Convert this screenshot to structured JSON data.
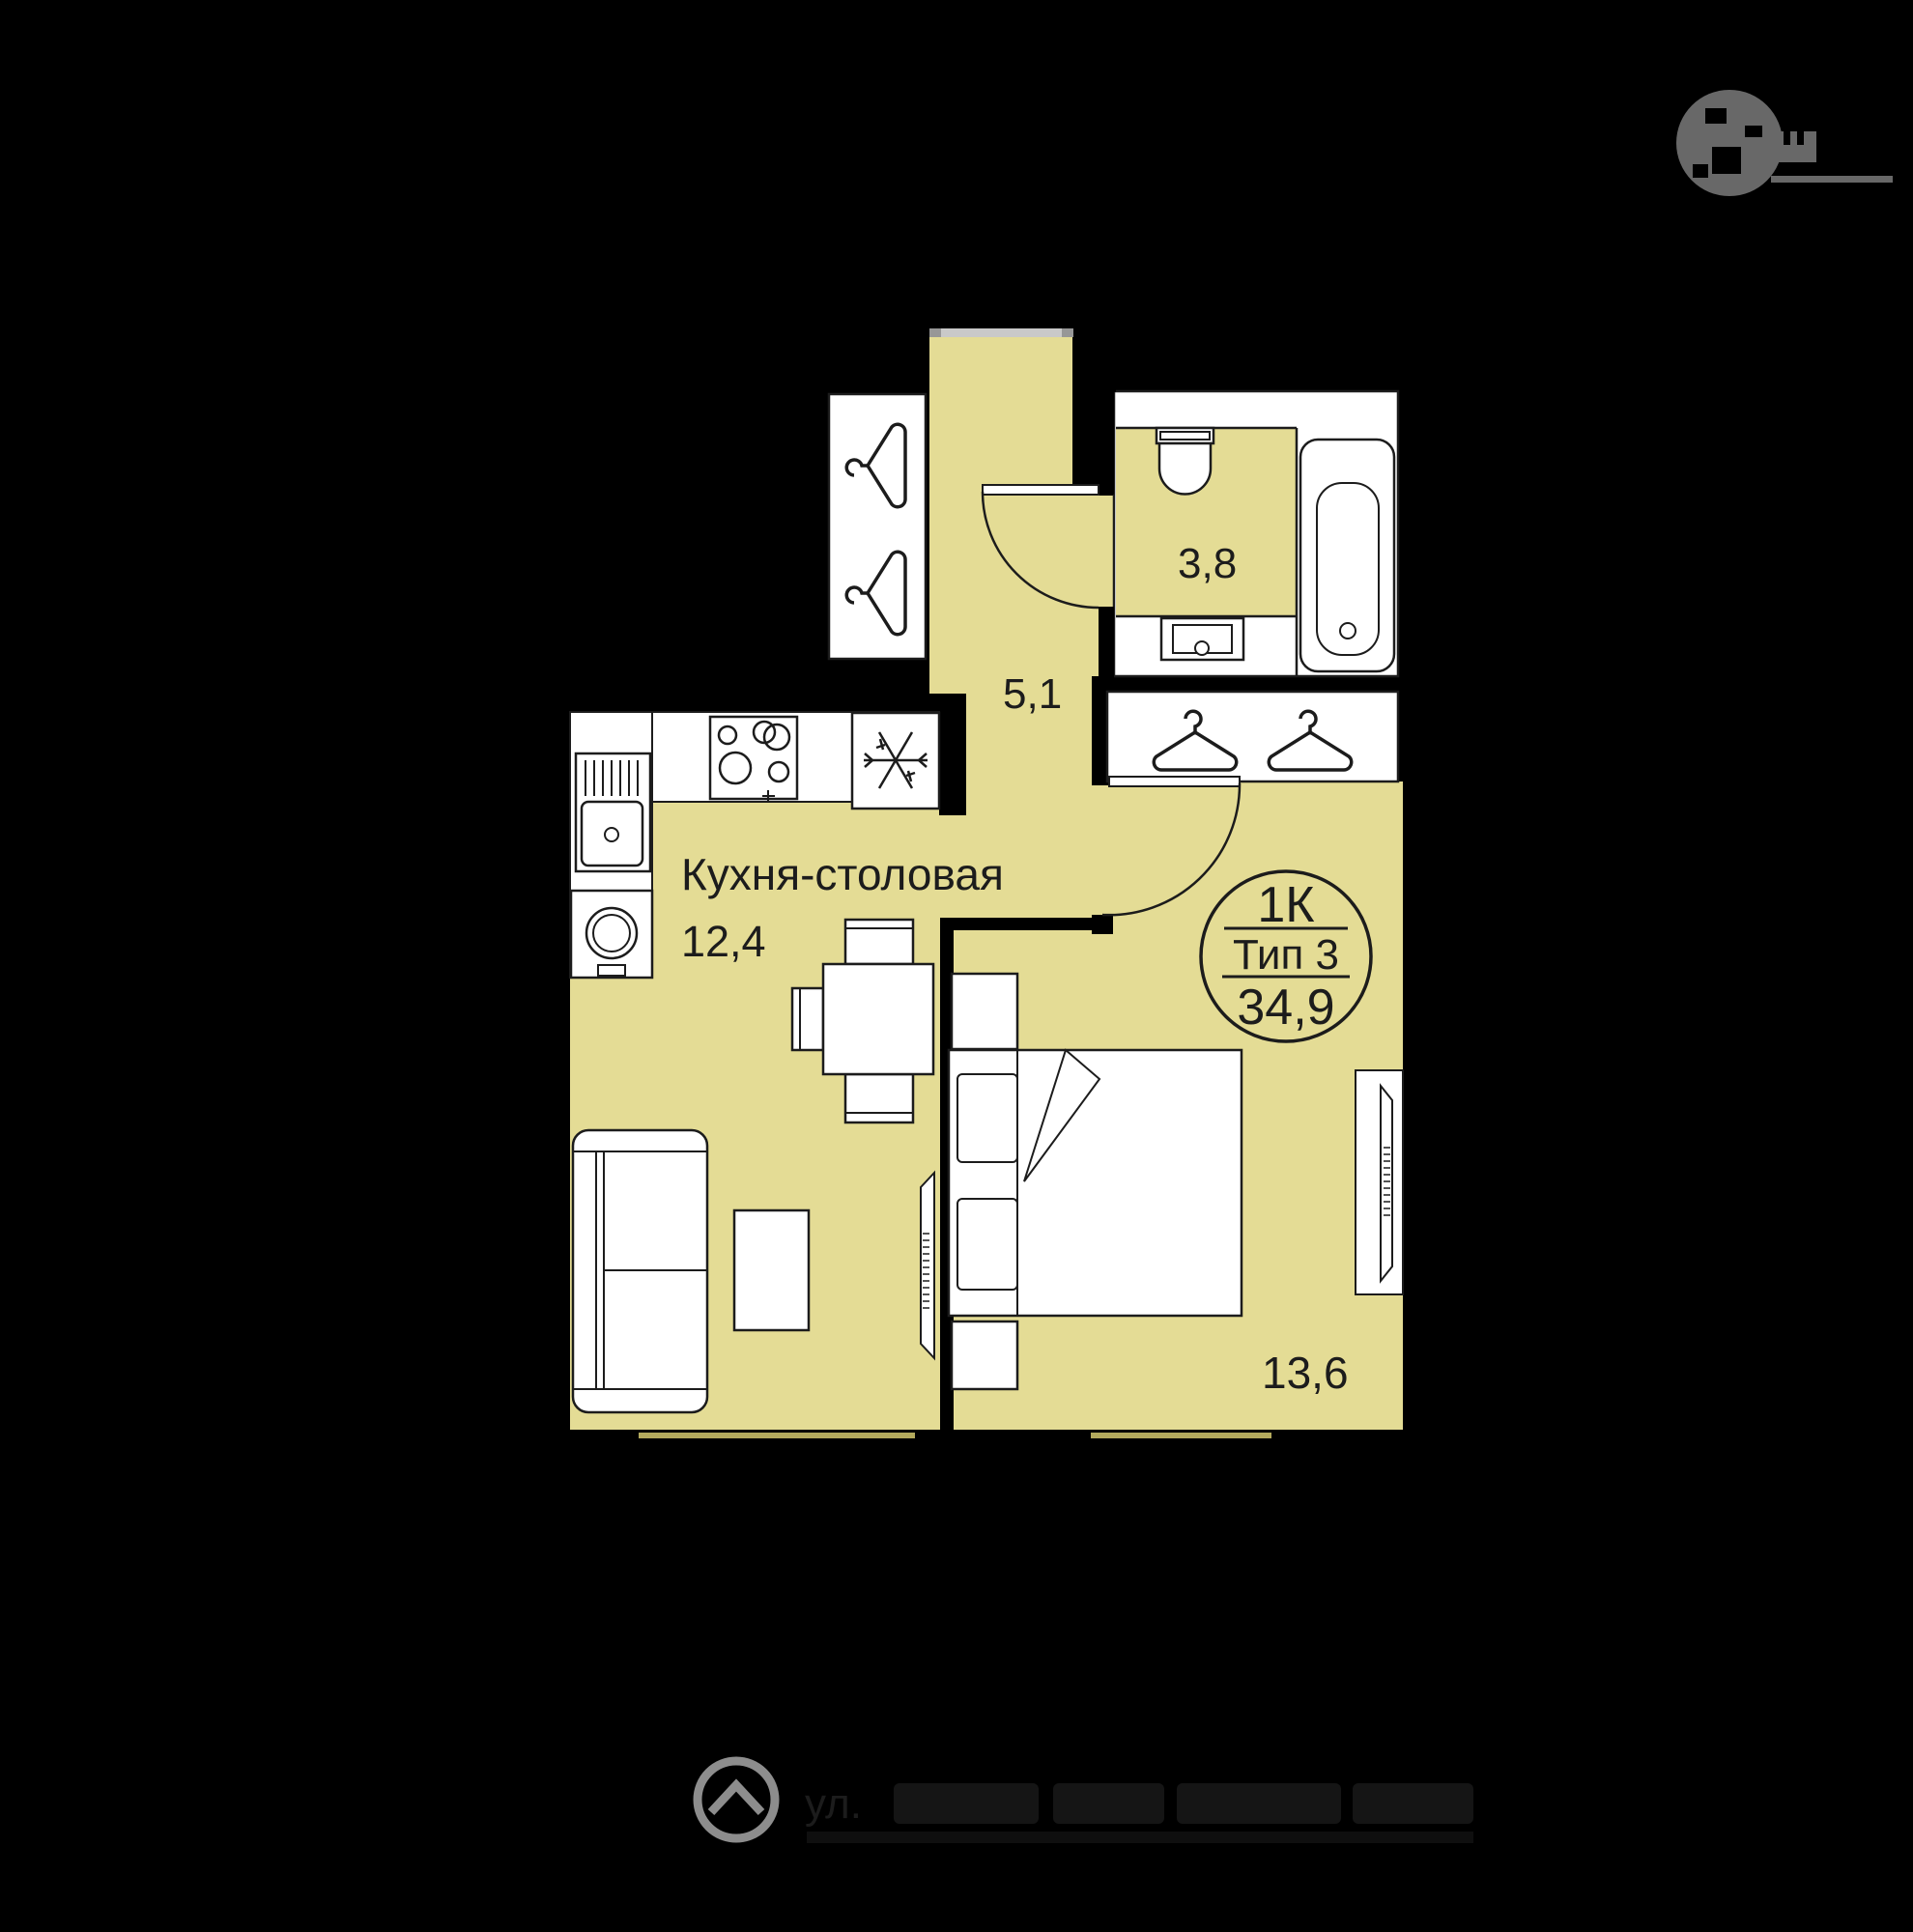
{
  "badge": {
    "rooms_label": "1К",
    "type_label": "Тип 3",
    "total_area": "34,9"
  },
  "rooms": {
    "kitchen": {
      "name": "Кухня-столовая",
      "area": "12,4"
    },
    "hallway": {
      "area": "5,1"
    },
    "bathroom": {
      "area": "3,8"
    },
    "bedroom": {
      "area": "13,6"
    }
  },
  "watermarks": {
    "address_prefix": "ул."
  },
  "icons": [
    "hanger-icon",
    "snowflake-icon",
    "toilet",
    "bathtub",
    "sink",
    "washing-machine",
    "stove-icon",
    "sofa",
    "bed",
    "dining-table",
    "tv-panel",
    "developer-logo"
  ],
  "colors": {
    "background": "#000000",
    "room_fill": "#e4dc95",
    "line": "#1c1c1c",
    "fixture_fill": "#ffffff",
    "entrance_door": "#c9c9c9",
    "window_bar": "#b3aa5d",
    "watermark_gray": "#8d8d8d"
  }
}
